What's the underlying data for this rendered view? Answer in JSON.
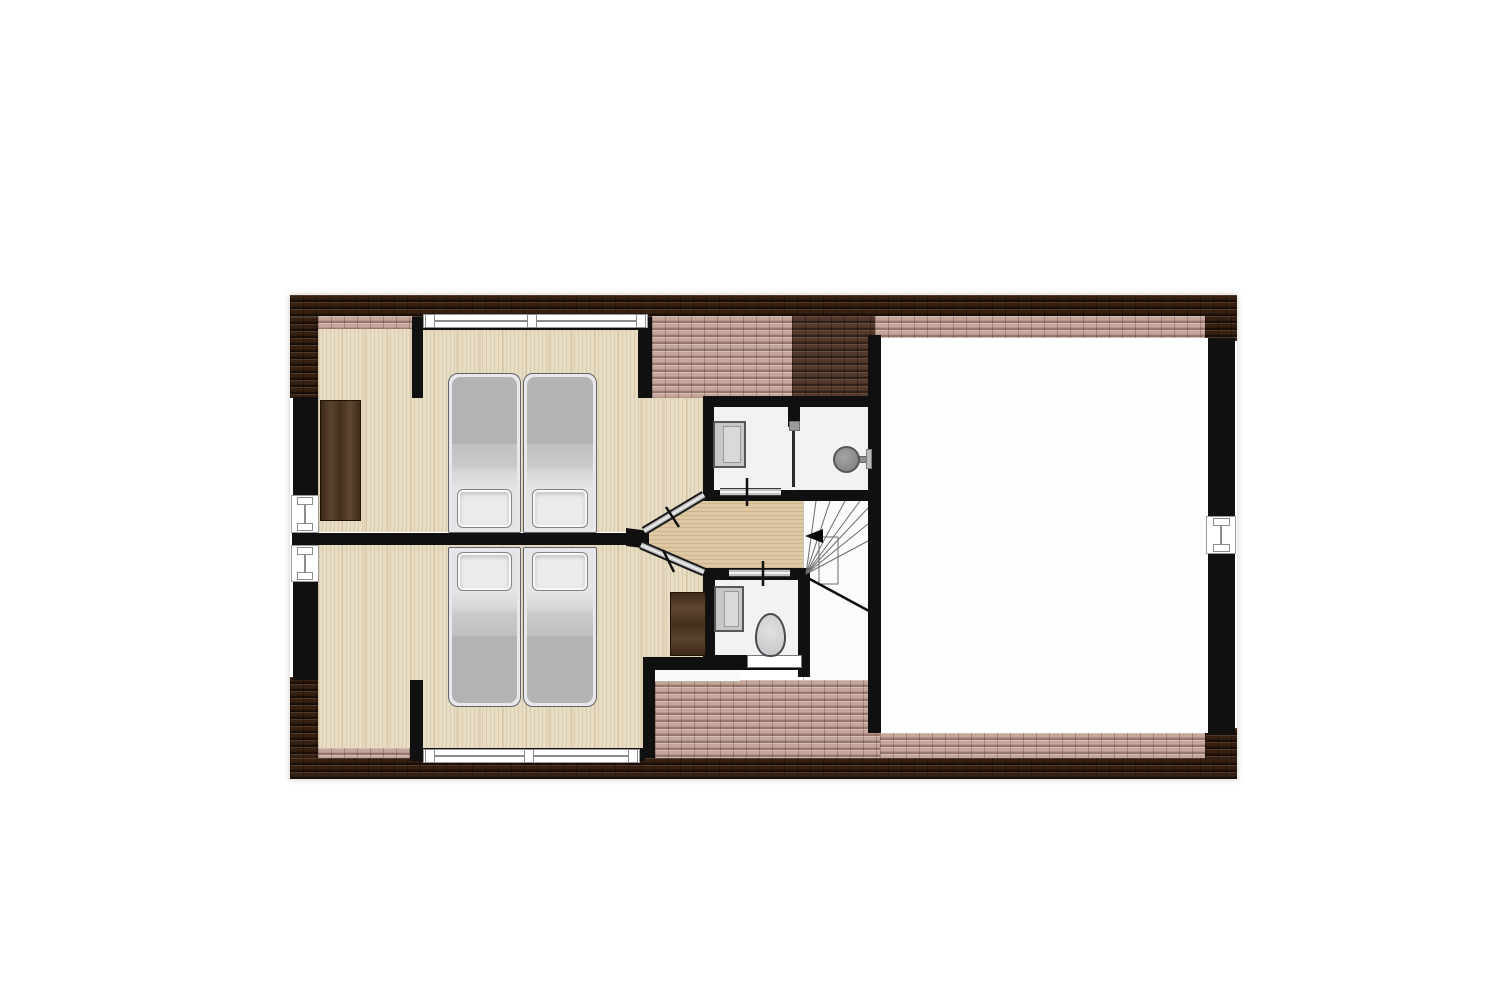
{
  "plan": {
    "kind": "residential floor plan — upper (attic) storey, no text labels rendered",
    "orientation": "landscape, roof-tile border around plan",
    "rooms": [
      {
        "id": "bedroom-top",
        "label": "Bedroom 1",
        "floor": "wood",
        "fixtures": [
          "two single beds pushed together",
          "wardrobe on left wall"
        ]
      },
      {
        "id": "bedroom-bottom",
        "label": "Bedroom 2",
        "floor": "wood",
        "fixtures": [
          "two single beds pushed together",
          "desk near door"
        ]
      },
      {
        "id": "washbasin-room",
        "label": "Washroom",
        "floor": "light",
        "fixtures": [
          "washbasin"
        ]
      },
      {
        "id": "shower-room",
        "label": "Shower room",
        "floor": "light",
        "fixtures": [
          "wall-mounted shower head"
        ]
      },
      {
        "id": "toilet-room",
        "label": "Toilet",
        "floor": "light",
        "fixtures": [
          "washbasin",
          "toilet with cistern"
        ]
      },
      {
        "id": "hallway",
        "label": "Landing",
        "floor": "wood"
      },
      {
        "id": "stairwell",
        "label": "Staircase",
        "details": "winder stairs, direction arrow pointing left"
      },
      {
        "id": "open-room",
        "label": "Open attic room",
        "floor": "white / unfurnished"
      }
    ],
    "counts": {
      "beds": 4,
      "windows": 5,
      "interior_doors": 4,
      "washbasins": 2,
      "toilets": 1,
      "showers": 1,
      "wardrobes": 1,
      "desks": 1
    },
    "stairs_arrow": "points left (toward landing)"
  },
  "palette": {
    "wall": "#101010",
    "roof_dark": "#372010",
    "roof_mid": "#553a2b",
    "roof_pink": "#c4a69b",
    "wood_bedroom": "#e8dcc3",
    "wood_hall": "#dfc9a5",
    "room_white": "#f3f2f0",
    "big_room_white": "#fdfdfd",
    "bed_duvet": "#b2b3b5",
    "bed_pillow": "#eaebed",
    "furniture_brown": "#4e3626",
    "fixture_gray": "#c7c7c7",
    "window_frame": "#8c8c8c",
    "door_gray": "#c2c2c2",
    "background": "#ffffff"
  }
}
